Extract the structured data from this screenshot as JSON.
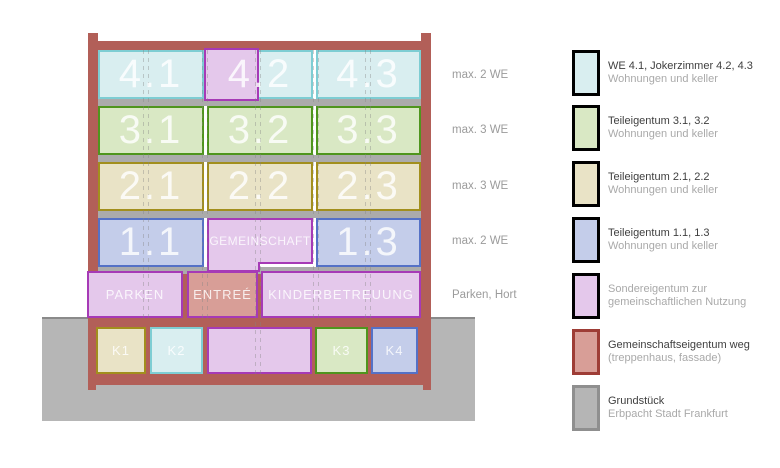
{
  "colors": {
    "frame": "#b25f58",
    "slab": "#ababab",
    "ground": "#b6b6b6",
    "ground-line": "#8a8a8a",
    "cyan-f": "#d9eef0",
    "cyan-b": "#7ecdd3",
    "green-f": "#d9e8c4",
    "green-b": "#4f951d",
    "tan-f": "#e9e3c6",
    "tan-b": "#a28f1d",
    "blue-f": "#c4cdea",
    "blue-b": "#5571c6",
    "pink-f": "#e4c8eb",
    "pink-b": "#a63ab6",
    "rose-f": "#d89e97",
    "rose-b": "#9e3d36",
    "gray-f": "#b5b5b5",
    "gray-b": "#8f8f8f",
    "label-gray": "#9b9b9b",
    "legend-primary": "#3f3f3f",
    "legend-secondary": "#a9a9a9"
  },
  "building": {
    "floors": [
      {
        "name": "floor-4",
        "annotation": "max. 2 WE",
        "rooms": [
          "4.1",
          "4.2",
          "4.3"
        ]
      },
      {
        "name": "floor-3",
        "annotation": "max. 3 WE",
        "rooms": [
          "3.1",
          "3.2",
          "3.3"
        ]
      },
      {
        "name": "floor-2",
        "annotation": "max. 3 WE",
        "rooms": [
          "2.1",
          "2.2",
          "2.3"
        ]
      },
      {
        "name": "floor-1",
        "annotation": "max. 2 WE",
        "rooms": [
          "1.1",
          "GEMEINSCHAFT",
          "1.3"
        ]
      },
      {
        "name": "ground-floor",
        "annotation": "Parken, Hort",
        "rooms": [
          "PARKEN",
          "ENTREÉ",
          "KINDERBETREUUNG"
        ]
      },
      {
        "name": "basement",
        "annotation": "",
        "rooms": [
          "K1",
          "K2",
          "K3",
          "K4"
        ]
      }
    ]
  },
  "legend": {
    "items": [
      {
        "name": "we-4",
        "line1": "WE 4.1, Jokerzimmer 4.2, 4.3",
        "line2": "Wohnungen und keller"
      },
      {
        "name": "teileigentum-3",
        "line1": "Teileigentum 3.1, 3.2",
        "line2": "Wohnungen und keller"
      },
      {
        "name": "teileigentum-2",
        "line1": "Teileigentum 2.1, 2.2",
        "line2": "Wohnungen und keller"
      },
      {
        "name": "teileigentum-1",
        "line1": "Teileigentum 1.1, 1.3",
        "line2": "Wohnungen und keller"
      },
      {
        "name": "sondereigentum",
        "line1": "Sondereigentum zur",
        "line2": "gemeinschaftlichen Nutzung"
      },
      {
        "name": "gemeinschaftseigentum",
        "line1": "Gemeinschaftseigentum weg",
        "line2": "(treppenhaus, fassade)"
      },
      {
        "name": "grundstueck",
        "line1": "Grundstück",
        "line2": "Erbpacht Stadt Frankfurt"
      }
    ]
  }
}
